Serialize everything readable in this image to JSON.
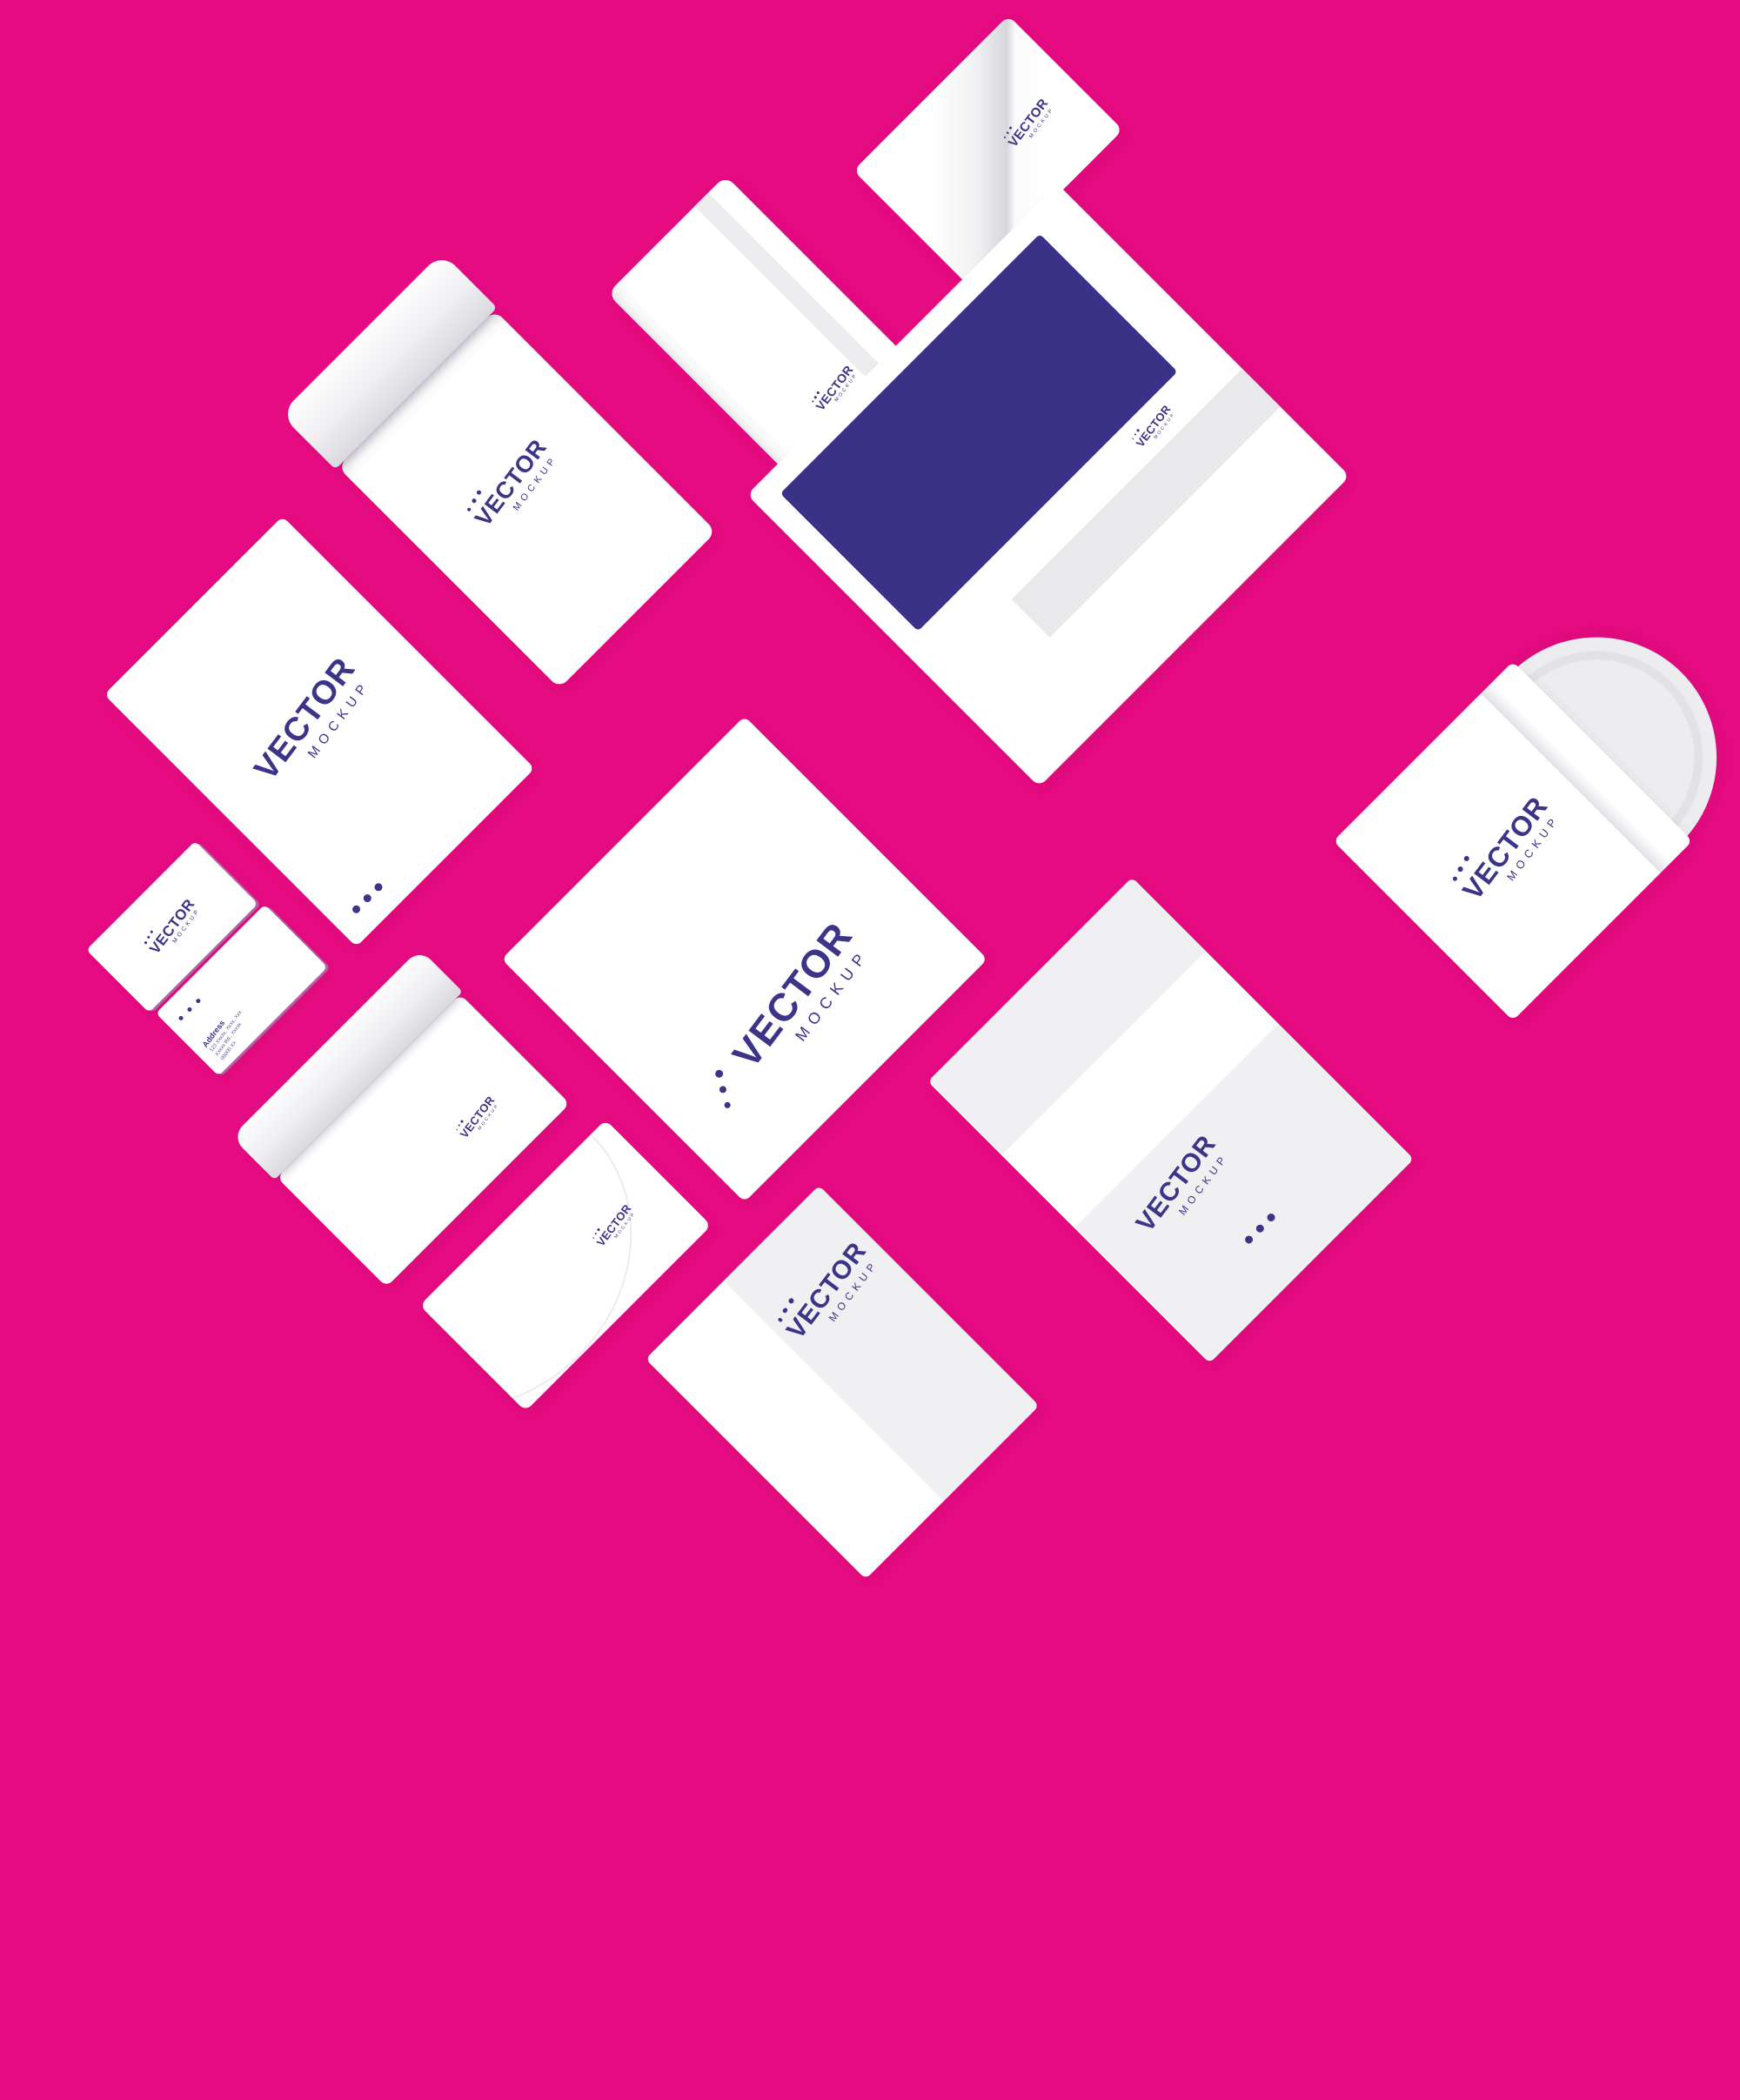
{
  "canvas": {
    "background_color": "#e50b80",
    "brand_navy": "#3b3487",
    "folder_navy": "#3a3286",
    "panel_gray": "#f0f0f2",
    "description": "Branding stationery mockup set rotated 45 degrees on magenta background"
  },
  "brand": {
    "name": "VECTOR",
    "sub": "MOCKUP"
  },
  "business_card_back": {
    "address_label": "Address",
    "address_lines": [
      "123 Xxxxx, Xxxx, Xxx",
      "Xxxxx Rd., Xxxxx",
      "00000 Xx"
    ]
  },
  "items": [
    {
      "name": "letterhead-a4",
      "type": "letterhead"
    },
    {
      "name": "envelope-large-open",
      "type": "pocket envelope with open flap"
    },
    {
      "name": "envelope-top-seam",
      "type": "portrait envelope with side seam"
    },
    {
      "name": "page-curl-card",
      "type": "card with curled page"
    },
    {
      "name": "business-card-front",
      "type": "business card"
    },
    {
      "name": "business-card-back",
      "type": "business card with address"
    },
    {
      "name": "presentation-folder",
      "type": "folder with navy cover and pocket"
    },
    {
      "name": "square-sheet",
      "type": "large square sheet"
    },
    {
      "name": "envelope-c5-open",
      "type": "open envelope"
    },
    {
      "name": "envelope-closed",
      "type": "closed envelope"
    },
    {
      "name": "folded-letterhead",
      "type": "half-folded sheet"
    },
    {
      "name": "trifold-sheet",
      "type": "z-folded sheet"
    },
    {
      "name": "cd-sleeve",
      "type": "cd sleeve with disc"
    }
  ]
}
